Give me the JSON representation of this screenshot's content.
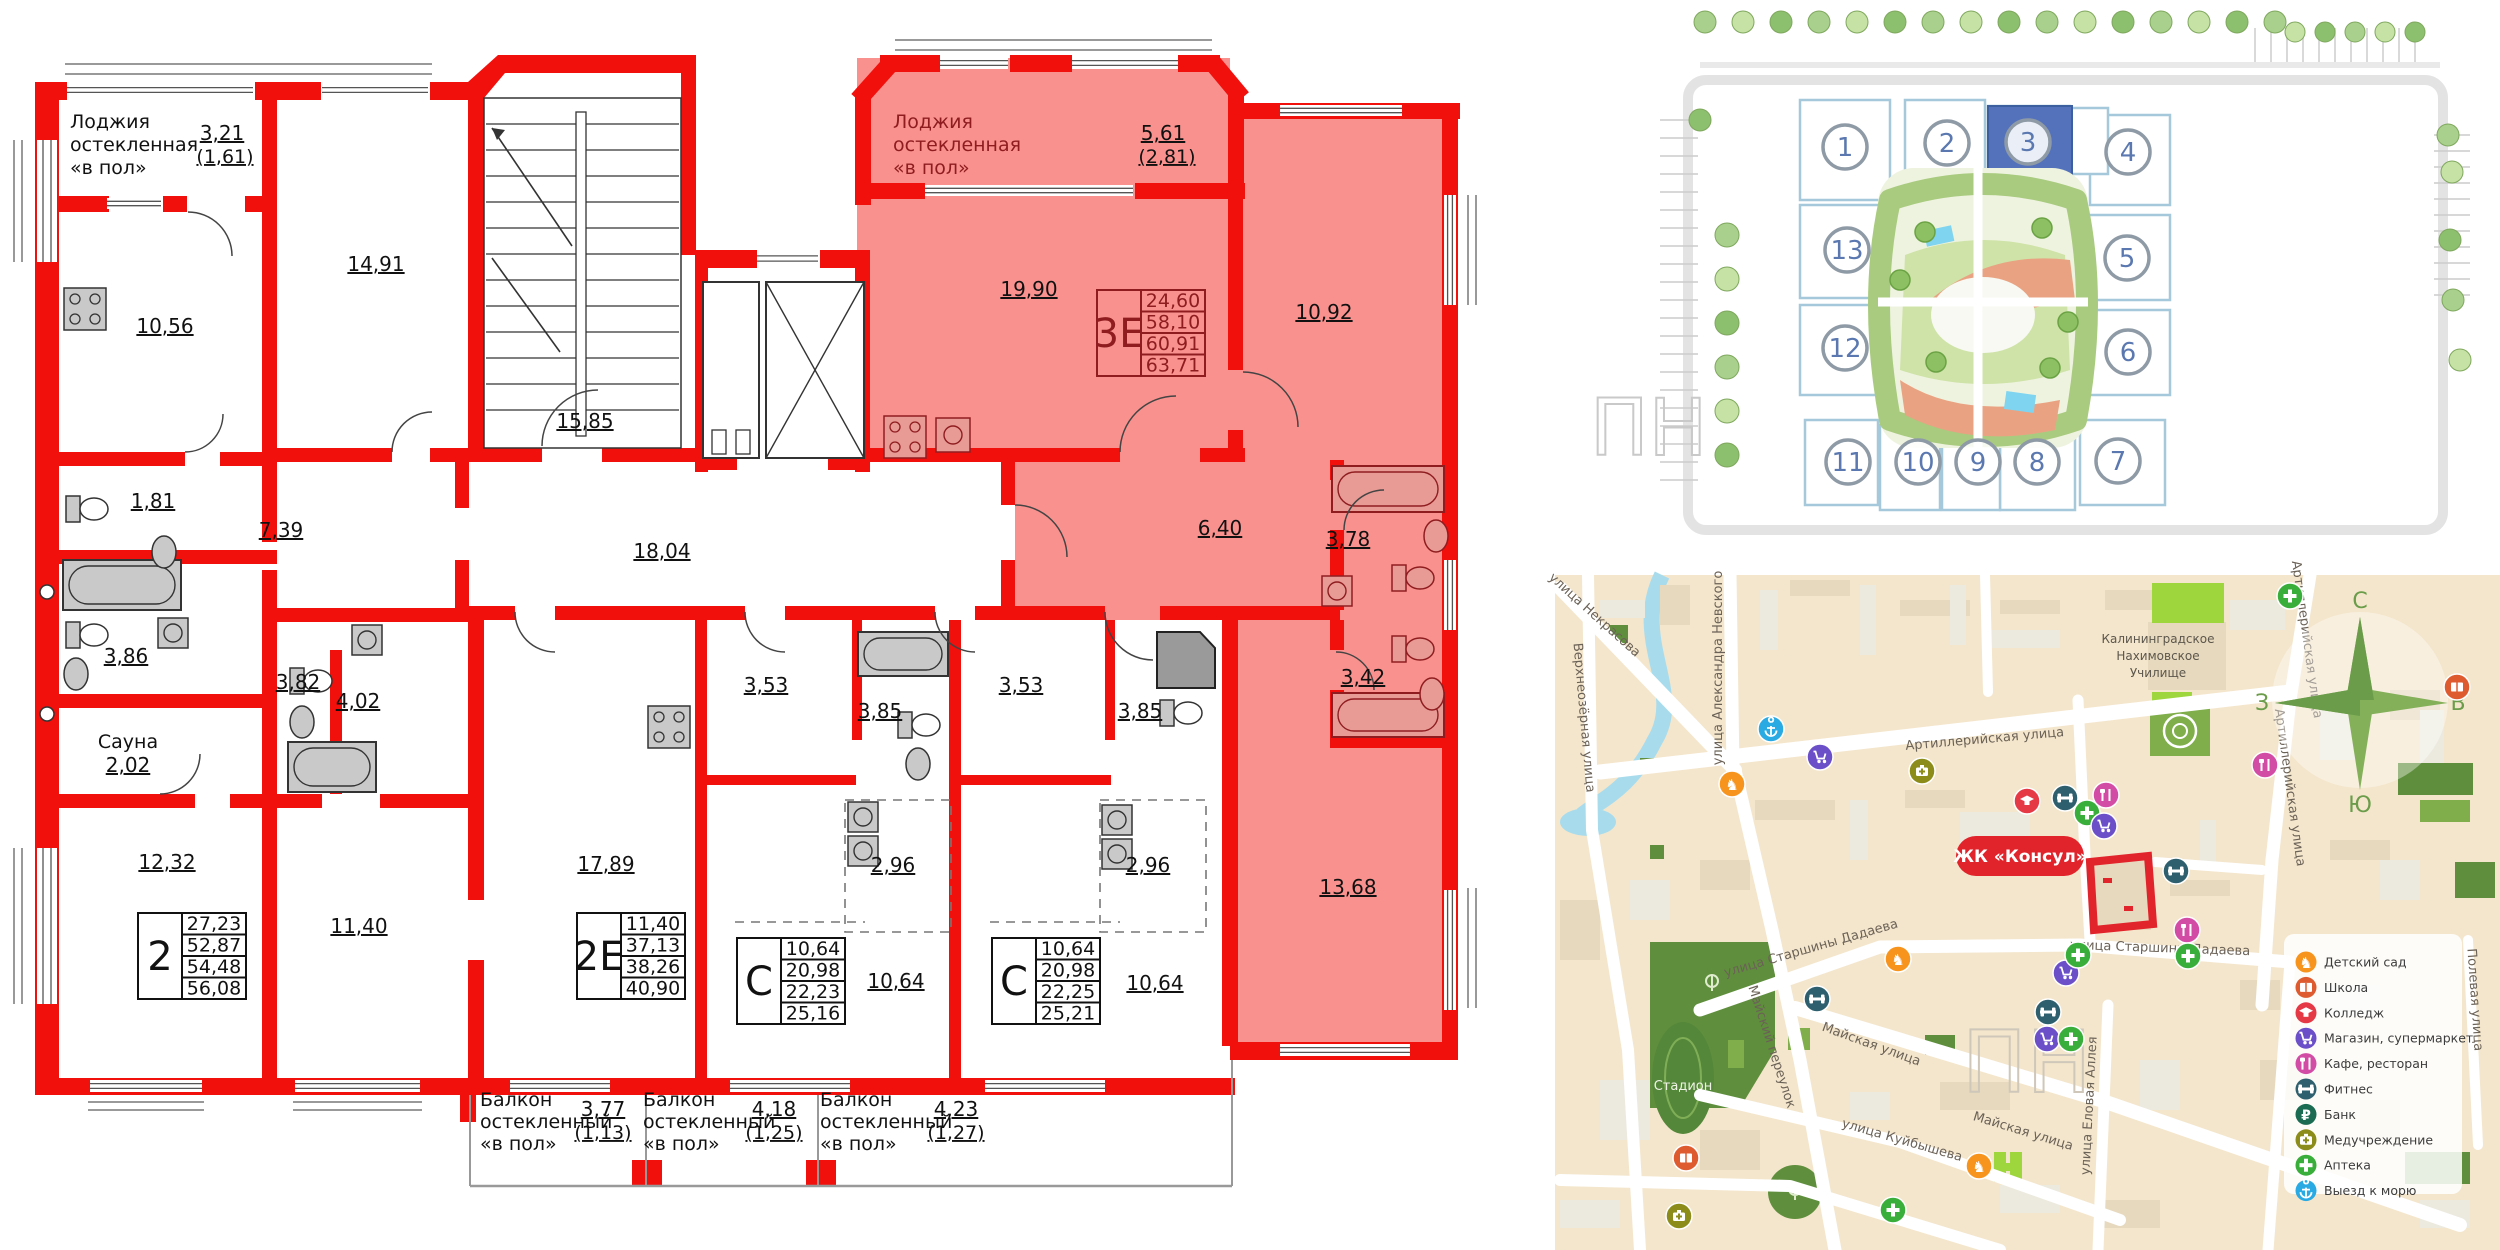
{
  "floor_plan": {
    "loggia_left": {
      "l1": "Лоджия",
      "l2": "остекленная",
      "l3": "«в пол»",
      "area": "3,21",
      "area_sub": "(1,61)"
    },
    "loggia_right": {
      "l1": "Лоджия",
      "l2": "остекленная",
      "l3": "«в пол»",
      "area": "5,61",
      "area_sub": "(2,81)"
    },
    "rooms": {
      "kitchen_left": "10,56",
      "living_1491": "14,91",
      "stairs": "15,85",
      "corridor": "18,04",
      "wc_left": "1,81",
      "hall_left": "7,39",
      "bath_left": "3,86",
      "sauna_label": "Сауна",
      "sauna_area": "2,02",
      "room_1232": "12,32",
      "bath_2e_a": "3,82",
      "bath_2e_b": "4,02",
      "room_1140": "11,40",
      "room_1789": "17,89",
      "st1_bath": "3,53",
      "st1_room": "3,85",
      "st1_hall": "2,96",
      "st1_living": "10,64",
      "st2_bath": "3,53",
      "st2_room": "3,85",
      "st2_hall": "2,96",
      "st2_living": "10,64",
      "kitchen_3e": "19,90",
      "room_1092": "10,92",
      "hall_3e": "6,40",
      "bath_3e": "3,78",
      "wc_3e": "3,42",
      "room_1368": "13,68"
    },
    "balconies": [
      {
        "l1": "Балкон",
        "l2": "остекленный",
        "l3": "«в пол»",
        "area": "3,77",
        "area_sub": "(1,13)"
      },
      {
        "l1": "Балкон",
        "l2": "остекленный",
        "l3": "«в пол»",
        "area": "4,18",
        "area_sub": "(1,25)"
      },
      {
        "l1": "Балкон",
        "l2": "остекленный",
        "l3": "«в пол»",
        "area": "4,23",
        "area_sub": "(1,27)"
      }
    ],
    "tables": [
      {
        "type": "2",
        "values": [
          "27,23",
          "52,87",
          "54,48",
          "56,08"
        ]
      },
      {
        "type": "2Е",
        "values": [
          "11,40",
          "37,13",
          "38,26",
          "40,90"
        ]
      },
      {
        "type": "С",
        "values": [
          "10,64",
          "20,98",
          "22,23",
          "25,16"
        ]
      },
      {
        "type": "С",
        "values": [
          "10,64",
          "20,98",
          "22,25",
          "25,21"
        ]
      },
      {
        "type": "3Е",
        "values": [
          "24,60",
          "58,10",
          "60,91",
          "63,71"
        ]
      }
    ]
  },
  "site_plan": {
    "highlighted": "3",
    "buildings": [
      {
        "num": "1"
      },
      {
        "num": "2"
      },
      {
        "num": "3"
      },
      {
        "num": "4"
      },
      {
        "num": "5"
      },
      {
        "num": "6"
      },
      {
        "num": "7"
      },
      {
        "num": "8"
      },
      {
        "num": "9"
      },
      {
        "num": "10"
      },
      {
        "num": "11"
      },
      {
        "num": "12"
      },
      {
        "num": "13"
      }
    ]
  },
  "map": {
    "complex_label": "ЖК «Консул»",
    "streets": [
      "улица Некрасова",
      "Верхнеозёрная улица",
      "улица Александра Невского",
      "Артиллерийская улица",
      "улица Старшины Дадаева",
      "Майский переулок",
      "Майская улица",
      "улица Куйбышева",
      "улица Еловая Аллея",
      "Полевая улица"
    ],
    "places": {
      "stadium": "Стадион",
      "college_l1": "Калининградское",
      "college_l2": "Нахимовское",
      "college_l3": "Училище"
    },
    "compass": {
      "n": "С",
      "s": "Ю",
      "w": "З",
      "e": "В"
    },
    "legend": [
      {
        "label": "Детский сад",
        "color": "#f7941e",
        "kind": "horse"
      },
      {
        "label": "Школа",
        "color": "#dd5b2f",
        "kind": "book"
      },
      {
        "label": "Колледж",
        "color": "#e63946",
        "kind": "cap"
      },
      {
        "label": "Магазин, супермаркет",
        "color": "#6a4fc9",
        "kind": "cart"
      },
      {
        "label": "Кафе, ресторан",
        "color": "#d24ca6",
        "kind": "food"
      },
      {
        "label": "Фитнес",
        "color": "#2e5f6e",
        "kind": "fitness"
      },
      {
        "label": "Банк",
        "color": "#1a6b52",
        "kind": "bank"
      },
      {
        "label": "Медучреждение",
        "color": "#8b8c1a",
        "kind": "med"
      },
      {
        "label": "Аптека",
        "color": "#3aae3a",
        "kind": "plus"
      },
      {
        "label": "Выезд к морю",
        "color": "#29aae3",
        "kind": "anchor"
      }
    ],
    "pois": [
      {
        "x": 1771,
        "y": 729,
        "kind": "anchor"
      },
      {
        "x": 1820,
        "y": 757,
        "kind": "cart"
      },
      {
        "x": 1922,
        "y": 771,
        "kind": "med"
      },
      {
        "x": 1732,
        "y": 784,
        "kind": "horse"
      },
      {
        "x": 2290,
        "y": 596,
        "kind": "plus"
      },
      {
        "x": 2457,
        "y": 687,
        "kind": "book"
      },
      {
        "x": 2265,
        "y": 765,
        "kind": "food"
      },
      {
        "x": 2027,
        "y": 801,
        "kind": "cap"
      },
      {
        "x": 2065,
        "y": 798,
        "kind": "fitness"
      },
      {
        "x": 2087,
        "y": 813,
        "kind": "plus"
      },
      {
        "x": 2106,
        "y": 795,
        "kind": "food"
      },
      {
        "x": 2104,
        "y": 826,
        "kind": "cart"
      },
      {
        "x": 2176,
        "y": 871,
        "kind": "fitness"
      },
      {
        "x": 2187,
        "y": 930,
        "kind": "food"
      },
      {
        "x": 2188,
        "y": 956,
        "kind": "plus"
      },
      {
        "x": 1898,
        "y": 959,
        "kind": "horse"
      },
      {
        "x": 1817,
        "y": 999,
        "kind": "fitness"
      },
      {
        "x": 2066,
        "y": 973,
        "kind": "cart"
      },
      {
        "x": 2078,
        "y": 955,
        "kind": "plus"
      },
      {
        "x": 2048,
        "y": 1012,
        "kind": "fitness"
      },
      {
        "x": 2047,
        "y": 1039,
        "kind": "cart"
      },
      {
        "x": 2071,
        "y": 1039,
        "kind": "plus"
      },
      {
        "x": 1686,
        "y": 1158,
        "kind": "book"
      },
      {
        "x": 1679,
        "y": 1216,
        "kind": "med"
      },
      {
        "x": 1893,
        "y": 1210,
        "kind": "plus"
      },
      {
        "x": 1979,
        "y": 1166,
        "kind": "horse"
      }
    ]
  }
}
